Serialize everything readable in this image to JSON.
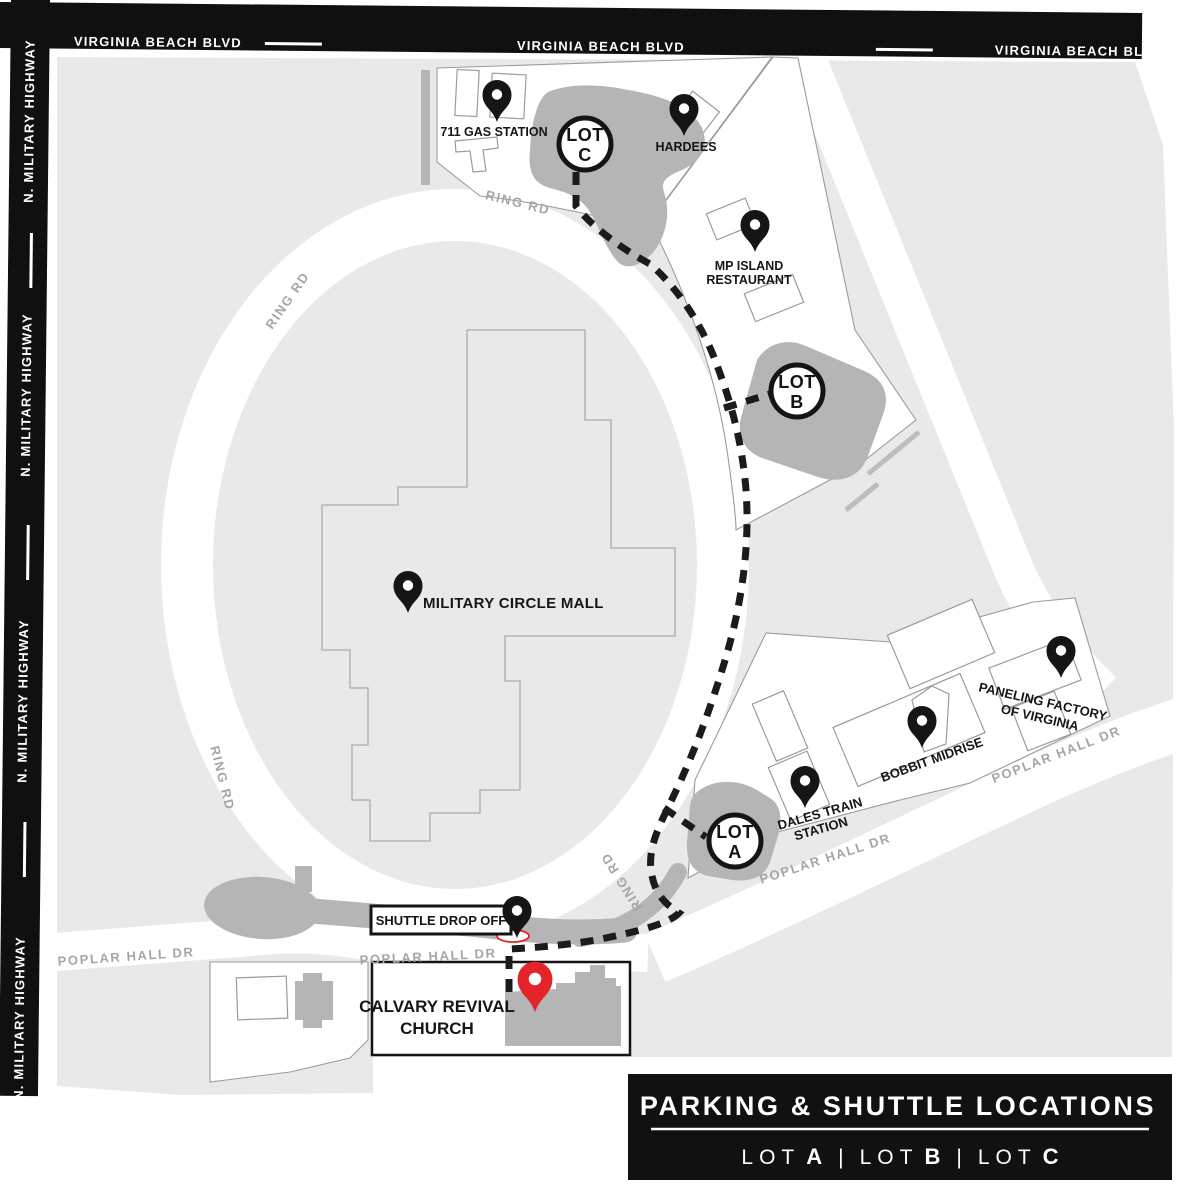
{
  "map": {
    "highways": {
      "top": [
        "VIRGINIA BEACH BLVD",
        "VIRGINIA BEACH BLVD",
        "VIRGINIA BEACH BLVD"
      ],
      "left": [
        "N. MILITARY HIGHWAY",
        "N. MILITARY HIGHWAY",
        "N. MILITARY HIGHWAY",
        "N. MILITARY HIGHWAY"
      ]
    },
    "roads": {
      "ring": [
        "RING RD",
        "RING RD",
        "RING RD",
        "RING RD"
      ],
      "poplar": [
        "POPLAR HALL DR",
        "POPLAR HALL DR",
        "POPLAR HALL DR",
        "POPLAR HALL DR"
      ]
    },
    "pois": {
      "gas": "711 GAS STATION",
      "hardees": "HARDEES",
      "mp_line1": "MP ISLAND",
      "mp_line2": "RESTAURANT",
      "mall": "MILITARY CIRCLE MALL",
      "paneling_line1": "PANELING FACTORY",
      "paneling_line2": "OF VIRGINIA",
      "bobbit": "BOBBIT MIDRISE",
      "dales_line1": "DALES TRAIN",
      "dales_line2": "STATION",
      "shuttle": "SHUTTLE DROP OFF",
      "church_line1": "CALVARY REVIVAL",
      "church_line2": "CHURCH"
    },
    "lots": {
      "c": {
        "line1": "LOT",
        "line2": "C"
      },
      "b": {
        "line1": "LOT",
        "line2": "B"
      },
      "a": {
        "line1": "LOT",
        "line2": "A"
      }
    }
  },
  "legend": {
    "title": "PARKING & SHUTTLE LOCATIONS",
    "separator": "|",
    "items": [
      {
        "prefix": "LOT",
        "letter": "A"
      },
      {
        "prefix": "LOT",
        "letter": "B"
      },
      {
        "prefix": "LOT",
        "letter": "C"
      }
    ]
  },
  "colors": {
    "bar_black": "#101010",
    "map_bg": "#e9e9e9",
    "lot_gray": "#b5b5b5",
    "pin_black": "#151515",
    "accent_red": "#e3242b",
    "legend_bg": "#111111"
  }
}
